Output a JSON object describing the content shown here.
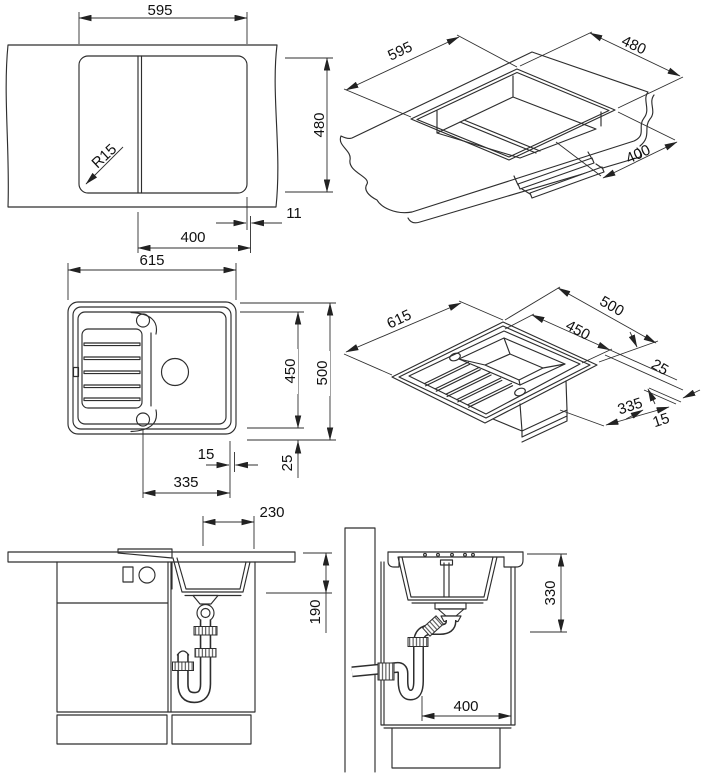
{
  "page": {
    "background": "#ffffff",
    "line_color": "#2e2e2e",
    "text_color": "#111111",
    "description": "sink-installation-technical-drawing"
  },
  "views": {
    "cutout_plan": {
      "dims": {
        "width": "595",
        "height": "480",
        "corner_radius": "R15",
        "edge_offset": "11",
        "bowl_cut": "400"
      }
    },
    "counter_iso": {
      "dims": {
        "width": "595",
        "depth": "480",
        "bowl_width": "400"
      }
    },
    "sink_plan": {
      "dims": {
        "width": "615",
        "inner_length": "450",
        "length": "500",
        "rim_margin": "25",
        "edge": "15",
        "bowl_width": "335"
      }
    },
    "sink_iso": {
      "dims": {
        "width": "615",
        "depth": "500",
        "inner_depth": "450",
        "rim_margin": "25",
        "bowl_width": "335",
        "edge": "15"
      }
    },
    "front_elevation": {
      "dims": {
        "drain_offset": "230",
        "bowl_depth": "190"
      }
    },
    "side_elevation": {
      "dims": {
        "mount_depth": "330",
        "drain_offset": "400"
      }
    }
  }
}
